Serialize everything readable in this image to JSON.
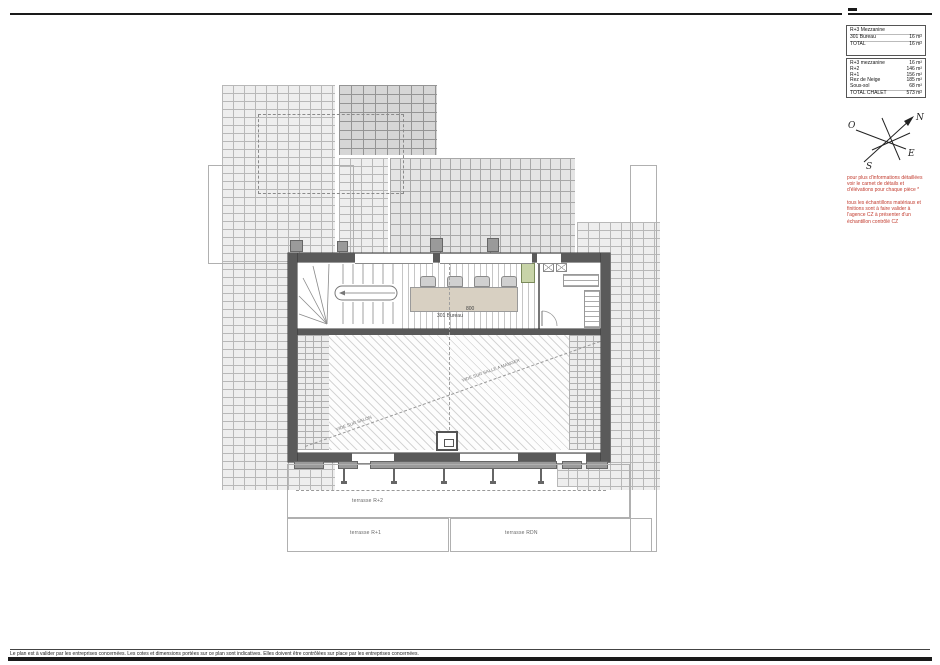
{
  "tables": {
    "mezzanine": {
      "rows": [
        {
          "label": "R+3 Mezzanine",
          "value": ""
        },
        {
          "label": "301 Bureau",
          "value": "16 m²"
        },
        {
          "label": "TOTAL",
          "value": "16 m²"
        }
      ]
    },
    "chalet": {
      "rows": [
        {
          "label": "R+3 mezzanine",
          "value": "16 m²"
        },
        {
          "label": "R+2",
          "value": "146 m²"
        },
        {
          "label": "R+1",
          "value": "156 m²"
        },
        {
          "label": "Rez de Neige",
          "value": "185 m²"
        },
        {
          "label": "Sous-sol",
          "value": "68 m²"
        },
        {
          "label": "TOTAL CHALET",
          "value": "573 m²"
        }
      ]
    }
  },
  "compass": {
    "north": "N",
    "east": "E",
    "south": "S",
    "west": "O"
  },
  "notes": {
    "note1": "pour plus d'informations détaillées voir le carnet de détails et d'élévations pour chaque pièce *",
    "note2": "tous les échantillons matériaux et finitions sont à faire valider à l'agence CZ à présenter d'un échantillon contrôlé CZ",
    "color": "#c23b2e"
  },
  "plan": {
    "room_label": "301 Bureau",
    "dimension": "800",
    "void_label_1": "VIDE SUR SALON",
    "void_label_2": "VIDE SUR SALLE A MANGER",
    "terrace_r2": "terrasse R+2",
    "terrace_r1": "terrasse R+1",
    "terrace_rdn": "terrasse RDN"
  },
  "footer": {
    "disclaimer": "Le plan est à valider par les entreprises concernées. Les cotes et dimensions portées sur ce plan sont indicatives. Elles doivent être contrôlées sur place par les entreprises concernées."
  },
  "colors": {
    "wall": "#5a5a5a",
    "table": "#d8d0c2",
    "cabinet_green": "#c8d4a8",
    "note_red": "#c23b2e"
  }
}
